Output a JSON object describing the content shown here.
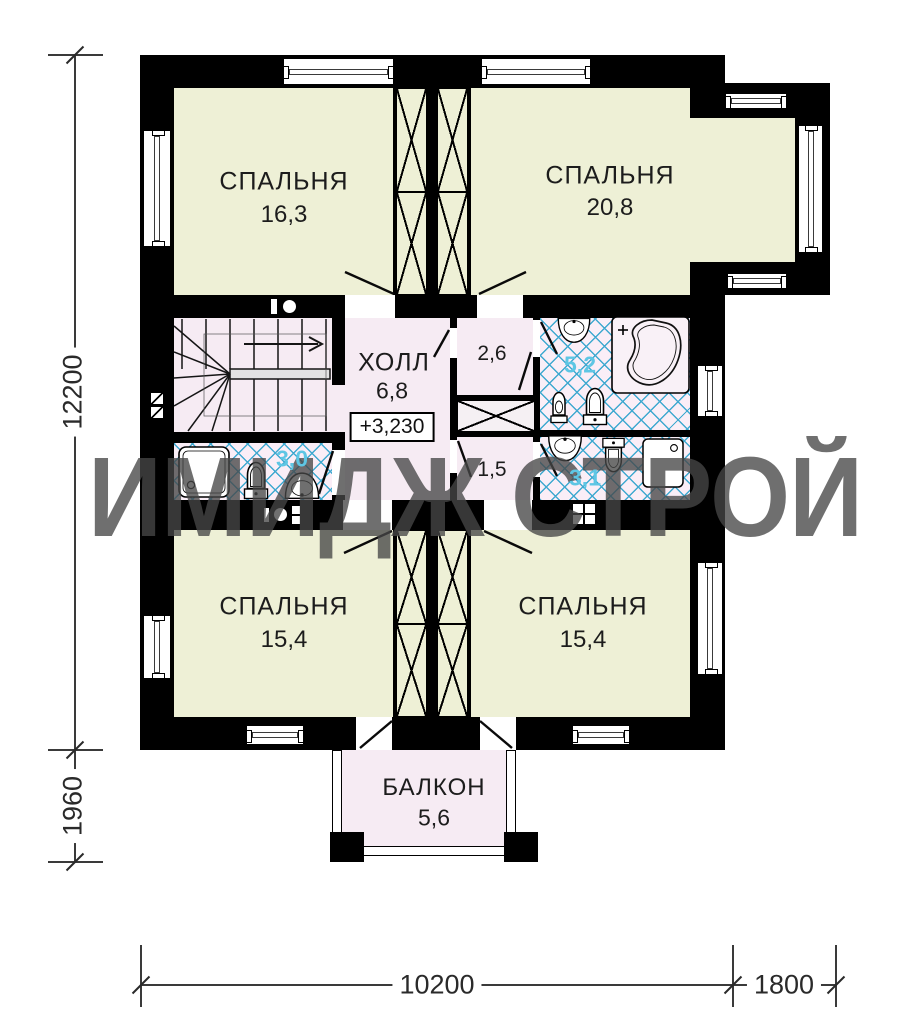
{
  "watermark": "ИМИДЖ СТРОЙ",
  "rooms": {
    "bedroom_top_left": {
      "label": "СПАЛЬНЯ",
      "area": "16,3"
    },
    "bedroom_top_right": {
      "label": "СПАЛЬНЯ",
      "area": "20,8"
    },
    "hall": {
      "label": "ХОЛЛ",
      "area": "6,8",
      "elevation_mark": "+3,230"
    },
    "closet_top": {
      "area": "2,6"
    },
    "bathroom_main": {
      "area": "5,2"
    },
    "bathroom_left": {
      "area": "3,0"
    },
    "closet_bottom": {
      "area": "1,5"
    },
    "bathroom_right": {
      "area": "3,1"
    },
    "bedroom_bottom_left": {
      "label": "СПАЛЬНЯ",
      "area": "15,4"
    },
    "bedroom_bottom_right": {
      "label": "СПАЛЬНЯ",
      "area": "15,4"
    },
    "balcony": {
      "label": "БАЛКОН",
      "area": "5,6"
    }
  },
  "dimensions": {
    "left_height": "12200",
    "left_balcony_depth": "1960",
    "bottom_width": "10200",
    "bottom_bay_width": "1800"
  },
  "colors": {
    "wall": "#000000",
    "room_fill": "#eef0d6",
    "hall_fill": "#f6ebf3",
    "tile_line": "#3fa9d0",
    "area_label_blue": "#5ec6e4",
    "watermark_gray": "#464646"
  }
}
